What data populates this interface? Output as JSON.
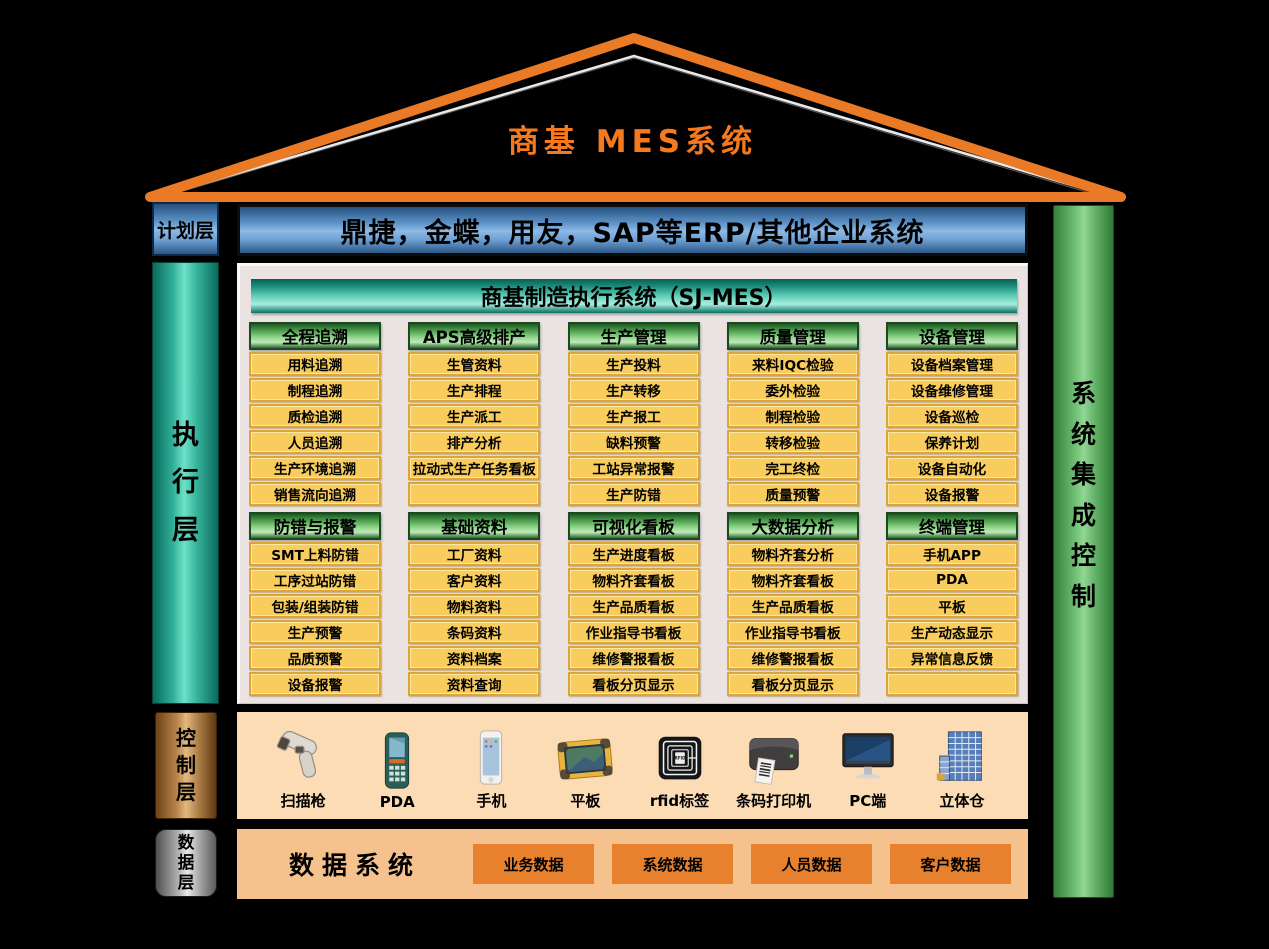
{
  "title": "商基  MES系统",
  "layers": {
    "plan": {
      "label": "计划层",
      "erp_bar": "鼎捷，金蝶，用友，SAP等ERP/其他企业系统"
    },
    "execution": {
      "label": "执行层",
      "header": "商基制造执行系统（SJ-MES）",
      "rows": [
        [
          {
            "title": "全程追溯",
            "items": [
              "用料追溯",
              "制程追溯",
              "质检追溯",
              "人员追溯",
              "生产环境追溯",
              "销售流向追溯"
            ]
          },
          {
            "title": "APS高级排产",
            "items": [
              "生管资料",
              "生产排程",
              "生产派工",
              "排产分析",
              "拉动式生产任务看板",
              ""
            ]
          },
          {
            "title": "生产管理",
            "items": [
              "生产投料",
              "生产转移",
              "生产报工",
              "缺料预警",
              "工站异常报警",
              "生产防错"
            ]
          },
          {
            "title": "质量管理",
            "items": [
              "来料IQC检验",
              "委外检验",
              "制程检验",
              "转移检验",
              "完工终检",
              "质量预警"
            ]
          },
          {
            "title": "设备管理",
            "items": [
              "设备档案管理",
              "设备维修管理",
              "设备巡检",
              "保养计划",
              "设备自动化",
              "设备报警"
            ]
          }
        ],
        [
          {
            "title": "防错与报警",
            "items": [
              "SMT上料防错",
              "工序过站防错",
              "包装/组装防错",
              "生产预警",
              "品质预警",
              "设备报警"
            ]
          },
          {
            "title": "基础资料",
            "items": [
              "工厂资料",
              "客户资料",
              "物料资料",
              "条码资料",
              "资料档案",
              "资料查询"
            ]
          },
          {
            "title": "可视化看板",
            "items": [
              "生产进度看板",
              "物料齐套看板",
              "生产品质看板",
              "作业指导书看板",
              "维修警报看板",
              "看板分页显示"
            ]
          },
          {
            "title": "大数据分析",
            "items": [
              "物料齐套分析",
              "物料齐套看板",
              "生产品质看板",
              "作业指导书看板",
              "维修警报看板",
              "看板分页显示"
            ]
          },
          {
            "title": "终端管理",
            "items": [
              "手机APP",
              "PDA",
              "平板",
              "生产动态显示",
              "异常信息反馈",
              ""
            ]
          }
        ]
      ]
    },
    "control": {
      "label": "控制层",
      "devices": [
        {
          "icon": "scanner-gun-icon",
          "label": "扫描枪"
        },
        {
          "icon": "pda-icon",
          "label": "PDA"
        },
        {
          "icon": "phone-icon",
          "label": "手机"
        },
        {
          "icon": "tablet-icon",
          "label": "平板"
        },
        {
          "icon": "rfid-tag-icon",
          "label": "rfid标签"
        },
        {
          "icon": "barcode-printer-icon",
          "label": "条码打印机"
        },
        {
          "icon": "pc-icon",
          "label": "PC端"
        },
        {
          "icon": "warehouse-icon",
          "label": "立体仓"
        }
      ]
    },
    "data": {
      "label": "数据层",
      "title": "数据系统",
      "boxes": [
        "业务数据",
        "系统数据",
        "人员数据",
        "客户数据"
      ]
    },
    "right_bar": {
      "label": "系统集成控制"
    }
  },
  "colors": {
    "background": "#000000",
    "roof_orange": "#ea7a26",
    "title_orange": "#f4791f",
    "erp_blue": "#5e93c8",
    "teal": "#2fae97",
    "module_header_green": "#8fd489",
    "item_yellow": "#f8cd5e",
    "item_border": "#dda438",
    "panel_bg": "#eae3e1",
    "control_band": "#fbdcb5",
    "data_band": "#f5c18c",
    "data_box_orange": "#e8812d",
    "right_bar_green": "#6dbd72",
    "control_label_copper": "#b9854a",
    "data_label_silver": "#b9b9b9"
  }
}
